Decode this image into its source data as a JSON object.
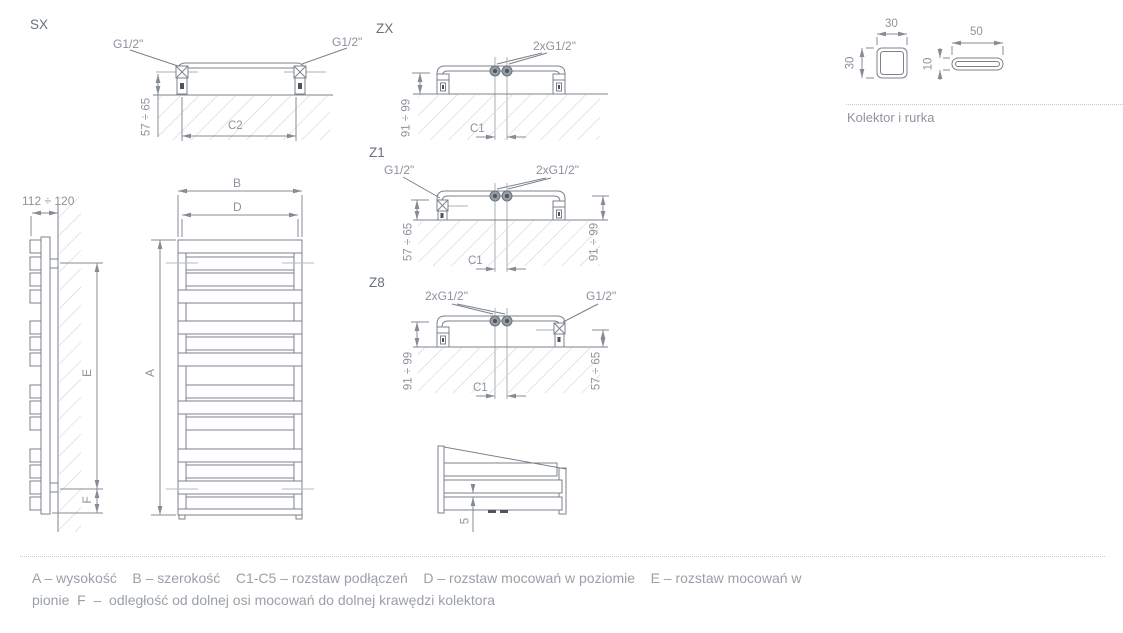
{
  "colors": {
    "line": "#7b828a",
    "dim_line": "#868c94",
    "hatch": "#c9cdd2",
    "text": "#8d939c",
    "section_label": "#6a717a",
    "legend_text": "#9aa0a8",
    "background": "#ffffff"
  },
  "sections": {
    "sx": {
      "title": "SX",
      "conn_left": "G1/2\"",
      "conn_right": "G1/2\"",
      "dim_height": "57 ÷ 65",
      "dim_width": "C2"
    },
    "zx": {
      "title": "ZX",
      "conn_center": "2xG1/2\"",
      "dim_height": "91 ÷ 99",
      "dim_width": "C1"
    },
    "z1": {
      "title": "Z1",
      "conn_left": "G1/2\"",
      "conn_center": "2xG1/2\"",
      "dim_height_left": "57 ÷ 65",
      "dim_height_right": "91 ÷ 99",
      "dim_width": "C1"
    },
    "z8": {
      "title": "Z8",
      "conn_center": "2xG1/2\"",
      "conn_right": "G1/2\"",
      "dim_height_left": "91 ÷ 99",
      "dim_height_right": "57 ÷ 65",
      "dim_width": "C1"
    },
    "detail": {
      "dim_gap": "5"
    },
    "side_view": {
      "dim_depth": "112 ÷ 120",
      "dim_mount_vertical": "E",
      "dim_bottom_offset": "F"
    },
    "front_view": {
      "dim_height": "A",
      "dim_width": "B",
      "dim_mount_horizontal": "D"
    },
    "profiles": {
      "caption": "Kolektor i rurka",
      "square_width": "30",
      "square_height": "30",
      "tube_width": "50",
      "tube_height": "10"
    }
  },
  "legend": {
    "line1": "A – wysokość    B – szerokość    C1-C5 – rozstaw podłączeń    D – rozstaw mocowań w poziomie    E – rozstaw mocowań w",
    "line2": "pionie  F  –  odległość od dolnej osi mocowań do dolnej krawędzi kolektora"
  }
}
